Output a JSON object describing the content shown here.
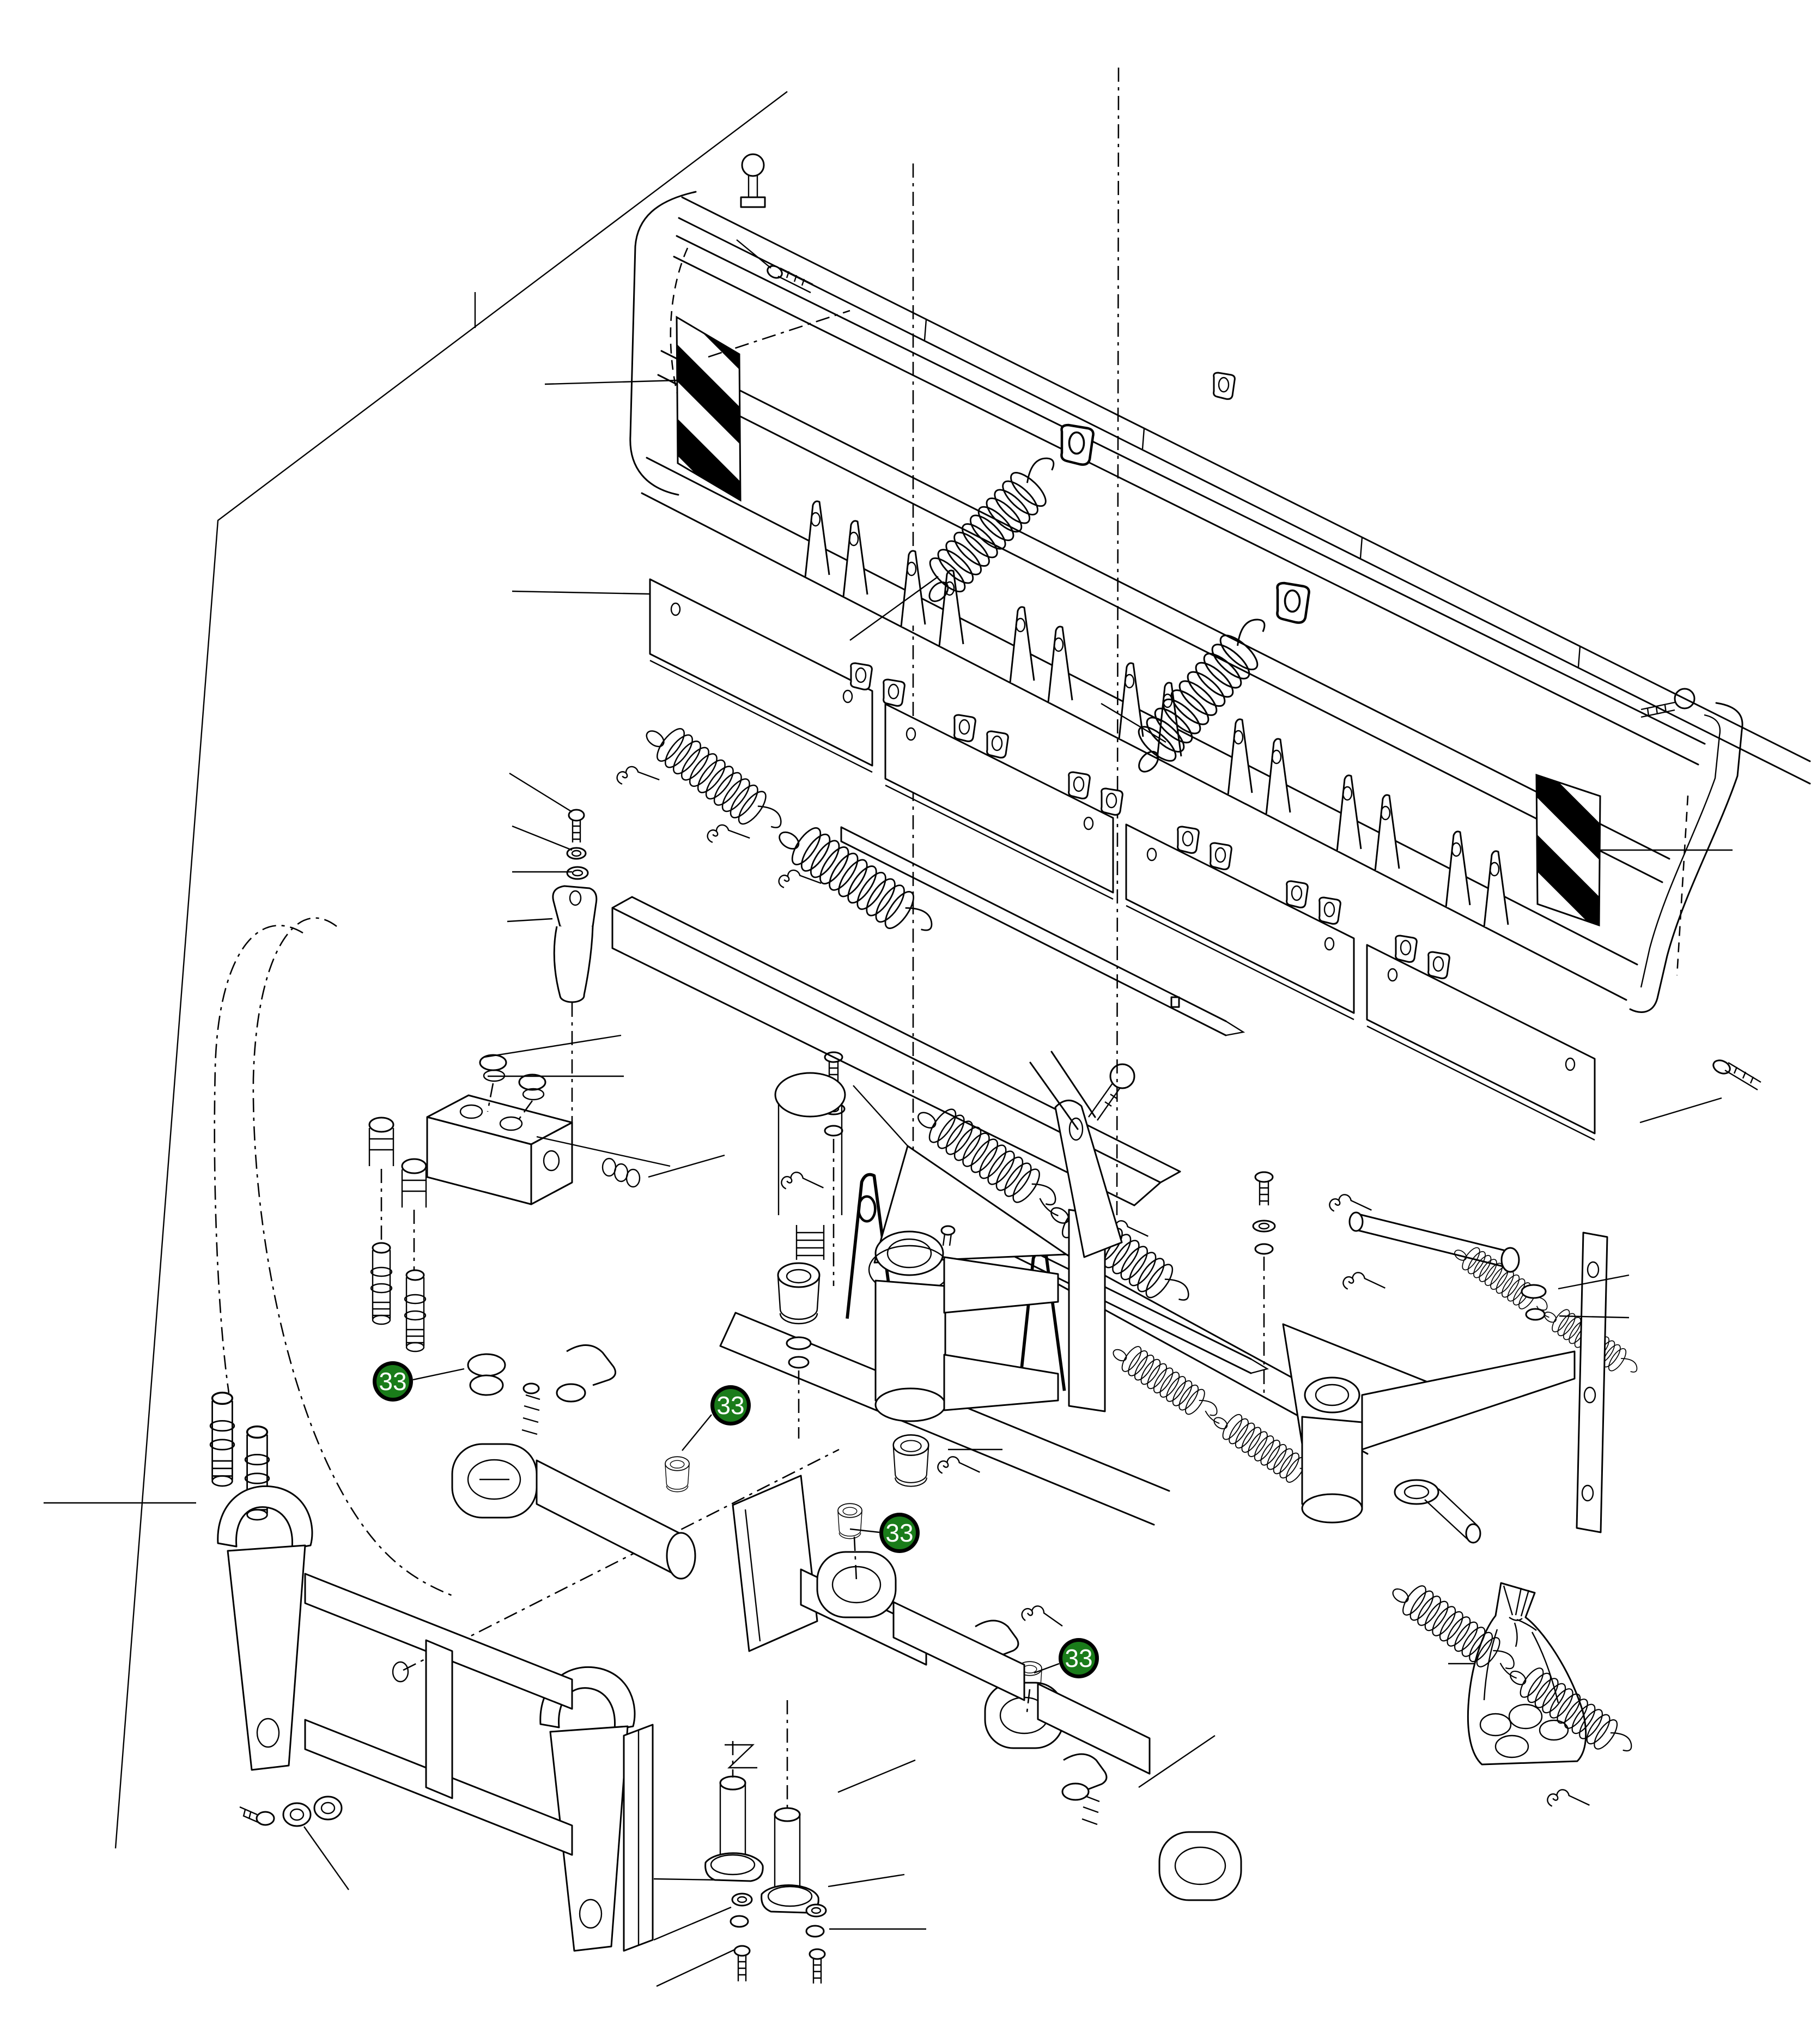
{
  "diagram": {
    "figure_type": "exploded-parts-diagram",
    "description_semantic": "snow-plow-blade-exploded-view",
    "background_color": "#ffffff",
    "line_color": "#000000",
    "callout_style": {
      "fill": "#1a7c1a",
      "ring": "#000000",
      "text": "#ffffff"
    },
    "callouts": [
      {
        "label": "33"
      },
      {
        "label": "33"
      },
      {
        "label": "33"
      },
      {
        "label": "33"
      }
    ],
    "components": [
      "moldboard-blade",
      "warning-stripe-decal-left",
      "warning-stripe-decal-right",
      "trip-spring-large-left",
      "trip-spring-large-right",
      "spring-eyebolt-assemblies",
      "rib-gussets",
      "hinge-lugs",
      "trip-edge-plates",
      "pivot-rods",
      "hairpin-cotters",
      "center-pivot-clevis",
      "king-pin",
      "a-frame-beams",
      "tie-rod-left",
      "tie-rod-right",
      "hydraulic-manifold-block",
      "hydraulic-hoses",
      "quick-couplers",
      "quick-attach-frame",
      "hitch-pins",
      "hardware-bag",
      "bolts-washers-nuts"
    ]
  }
}
